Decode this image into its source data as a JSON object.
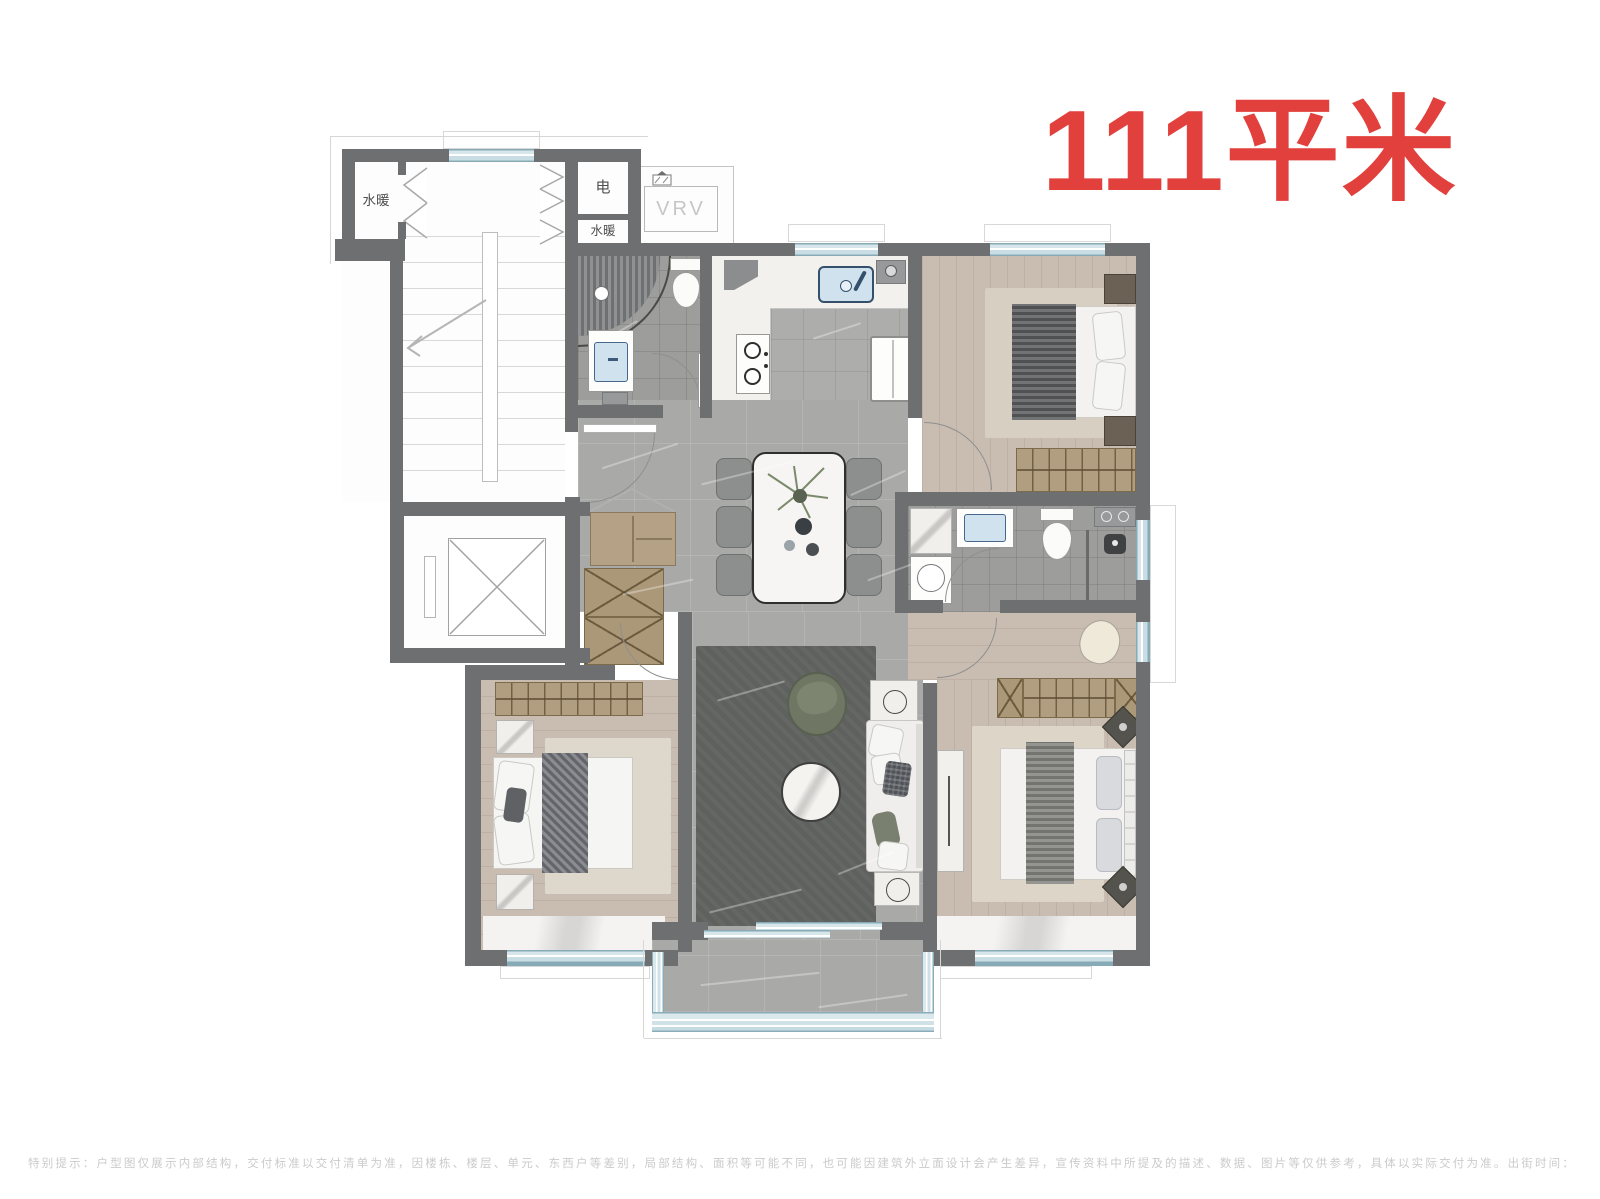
{
  "title": "111平米",
  "plan_labels": {
    "utility_room_left": "水暖",
    "electric_room": "电",
    "utility_room_mid": "水暖",
    "vrv_unit": "VRV"
  },
  "footer": {
    "disclaimer": "特别提示：户型图仅展示内部结构，交付标准以交付清单为准，因楼栋、楼层、单元、东西户等差别，局部结构、面积等可能不同，也可能因建筑外立面设计会产生差异，宣传资料中所提及的描述、数据、图片等仅供参考，具体以实际交付为准。出街时间：2022 年 8 月。"
  },
  "colors": {
    "title_red": "#e2403d",
    "wall_gray": "#6d6f71",
    "window_blue": "#cfe1e7",
    "floor_tile_gray": "#a9a9a7",
    "bath_tile_gray": "#9d9e9c",
    "wood_floor": "#c9bdb2",
    "cabinet_tan": "#b19e80",
    "rug_dark": "#5e605f",
    "rug_light": "#ded8cb",
    "disclaimer_gray": "#cbcbcb"
  }
}
